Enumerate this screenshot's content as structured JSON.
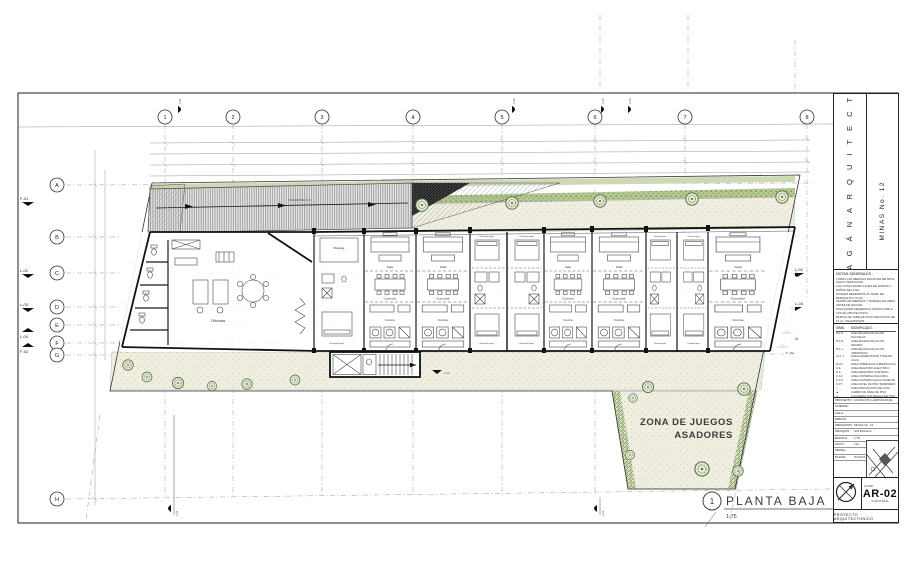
{
  "sheet": {
    "view_number": "1",
    "view_title": "PLANTA  BAJA",
    "view_scale": "1:75"
  },
  "plan": {
    "zona_line1": "ZONA DE JUEGOS",
    "zona_line2": "ASADORES",
    "ramp_label": "PENDIENTE 15 %",
    "colindancia_label": "COLINDANCIA",
    "walkway_level": "L-01",
    "rooms": {
      "sala": "Sala",
      "comedor": "Comedor",
      "cocina": "Cocina",
      "recamara": "Recámara ppal.",
      "bodega": "Bodega",
      "oficinas": "Oficinas"
    }
  },
  "grid": {
    "columns": [
      "1",
      "2",
      "3",
      "4",
      "5",
      "6",
      "7",
      "8"
    ],
    "rows": [
      "A",
      "B",
      "C",
      "D",
      "E",
      "F",
      "G",
      "H"
    ]
  },
  "section_markers": {
    "left": [
      "F-01",
      "L-02",
      "L-03",
      "L-04",
      "F-02"
    ],
    "right": [
      "L-02",
      "L-03",
      "L-04",
      "F-02"
    ],
    "top": [
      "C-01",
      "C-02",
      "C-03",
      "C-04"
    ],
    "bottom": [
      "L-01",
      "L-01"
    ]
  },
  "titleblock": {
    "firm_name": "B A R R A G Á N   A R Q U I T E C T O S   S.C",
    "project_name": "MINAS No. 12",
    "notes_title": "NOTAS  GENERALES :",
    "notes_lines": [
      "TODAS LAS MEDIDAS ESTAN EN METROS, SALVO INDICACION.",
      "LAS COTAS RIGEN A EJES DE MUROS Y PAÑOS DE LOSA.",
      "NIVELES REFERIDOS AL NIVEL DE BANQUETA N ±0.00.",
      "VERIFICAR MEDIDAS Y NIVELES EN OBRA ANTES DE INICIAR.",
      "CUALQUIER DIFERENCIA CONSULTARLA CON EL PROYECTISTA.",
      "MUROS DE TABIQUE ROJO RECOCIDO DE 14 cm. DE ESPESOR.",
      "CADENAS Y CASTILLOS SEGUN PLANO ESTRUCTURAL.",
      "INSTALACIONES SEGUN PLANOS DE INGENIERIA.",
      "CARPINTERIA Y CANCELERIA SEGUN PLANO DE DETALLES.",
      "ACABADOS SEGUN CUADRO DE ACABADOS.",
      "NO TOMAR MEDIDAS A ESCALA SOBRE ESTE PLANO."
    ],
    "legend_head_sym": "SIMB.",
    "legend_head_desc": "SIGNIFICADO :",
    "legend_rows": [
      {
        "sym": "B.A.P.",
        "desc": "LINEA BAJADA DE AGUAS PLUVIALES"
      },
      {
        "sym": "B.A.N.",
        "desc": "LINEA BAJADA DE AGUAS NEGRAS"
      },
      {
        "sym": "B.A.J.",
        "desc": "LINEA BAJADA DE AGUAS JABONOSAS"
      },
      {
        "sym": "A.LL.T.",
        "desc": "LINEA ALIMENTACION TOMA DE AGUA"
      },
      {
        "sym": "M.CA.",
        "desc": "LINEA MUEBLE EN CUBIERTA ALTA"
      },
      {
        "sym": "R.E.",
        "desc": "LINEA REGISTRO ELECTRICO"
      },
      {
        "sym": "R.S.",
        "desc": "LINEA REGISTRO SANITARIO"
      },
      {
        "sym": "C.A.F.",
        "desc": "LINEA CISTERNA AGUA FRIA"
      },
      {
        "sym": "C.A.C.",
        "desc": "LINEA CISTERNA AGUA CALIENTE"
      },
      {
        "sym": "N.P.T.",
        "desc": "LINEA NIVEL DE PISO TERMINADO"
      },
      {
        "sym": "+",
        "desc": "LINEA PROYECCION DE LOSA"
      },
      {
        "sym": "▲",
        "desc": "CAMBIO DE NIVEL DE PISO"
      },
      {
        "sym": "◎",
        "desc": "COLADERA CON REJILLA DE PISO"
      },
      {
        "sym": "⌁",
        "desc": "CAMBIO DE PENDIENTE EN LOSA"
      },
      {
        "sym": "Ⓝ",
        "desc": "CAMBIO DE ACABADO EN PISO"
      }
    ],
    "fields": [
      {
        "label": "PROYECTO :",
        "value": "CONJUNTO HABITACIONAL"
      },
      {
        "label": "CLIENTE :",
        "value": ""
      },
      {
        "label": "CALC. :",
        "value": ""
      },
      {
        "label": "DIBUJO :",
        "value": ""
      },
      {
        "label": "UBICACION :",
        "value": "MINAS No. 12"
      },
      {
        "label": "CROQUIS :",
        "value": "SIN ESCALA"
      },
      {
        "label": "ESCALA :",
        "value": "1:75"
      },
      {
        "label": "ACOT. :",
        "value": "mts."
      },
      {
        "label": "FECHA :",
        "value": ""
      },
      {
        "label": "PLANO :",
        "value": "PLANTA BAJA"
      }
    ],
    "clave_label": "CLAVE :",
    "sheet_code": "AR-02",
    "sheet_caption": "PLANTA BAJA",
    "footer": "PROYECTO ARQUITECTONICO"
  },
  "colors": {
    "garden_green": "#b5c793",
    "path_cream": "#efeee1",
    "line": "#333333"
  }
}
